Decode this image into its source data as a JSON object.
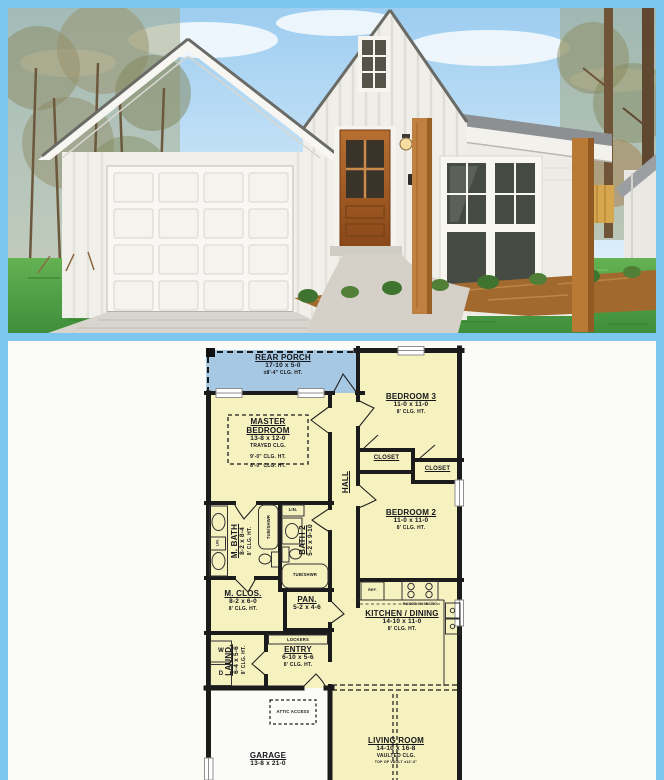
{
  "colors": {
    "frame_blue": "#7cc6ef",
    "plan_paper": "#fbfbf7",
    "room_yellow": "#f6f2c0",
    "porch_blue": "#a6c8e2",
    "wall_black": "#1b1b1b",
    "door_wood": "#a55f28",
    "grass_green": "#4f9e45",
    "sky_blue": "#9dcdf0"
  },
  "floor_plan": {
    "rear_porch": {
      "name": "REAR PORCH",
      "dims": "17-10 x 5-0",
      "clg": "±8'-4\" CLG. HT."
    },
    "bedroom3": {
      "name": "BEDROOM 3",
      "dims": "11-0 x 11-0",
      "clg": "8' CLG. HT."
    },
    "master_bedroom": {
      "name1": "MASTER",
      "name2": "BEDROOM",
      "dims": "13-8 x 12-0",
      "clg1": "TRAYED CLG.",
      "clg2": "9'-0\" CLG. HT.",
      "clg3": "8'-0\" CLG. HT."
    },
    "closet_left": {
      "name": "CLOSET"
    },
    "closet_right": {
      "name": "CLOSET"
    },
    "bedroom2": {
      "name": "BEDROOM 2",
      "dims": "11-0 x 11-0",
      "clg": "8' CLG. HT."
    },
    "hall": {
      "name": "HALL"
    },
    "master_bath": {
      "name": "M. BATH",
      "dims": "8-2 x 8-4",
      "clg": "8' CLG. HT."
    },
    "bath2": {
      "name": "BATH 2",
      "dims": "5-2 x 9-10"
    },
    "master_closet": {
      "name": "M. CLOS.",
      "dims": "8-2 x 6-0",
      "clg": "8' CLG. HT."
    },
    "pantry": {
      "name": "PAN.",
      "dims": "5-2 x 4-6"
    },
    "kitchen_dining": {
      "name": "KITCHEN / DINING",
      "dims": "14-10 x 11-0",
      "clg": "8' CLG. HT."
    },
    "laundry": {
      "name": "LAUND.",
      "dims": "6-4 x 5-6",
      "clg": "8' CLG. HT."
    },
    "entry": {
      "name": "ENTRY",
      "dims": "6-10 x 5-6",
      "clg": "8' CLG. HT."
    },
    "garage": {
      "name": "GARAGE",
      "dims": "13-8 x 21-0"
    },
    "living_room": {
      "name": "LIVING ROOM",
      "dims": "14-10 x 16-8",
      "clg1": "VAULTED CLG.",
      "clg2": "TOP OF VAULT ±12'-0\""
    },
    "fixtures": {
      "tub_shower_master": "TUB/SHWR",
      "tub_shower_bath2": "TUB/SHWR",
      "linen_master": "LIN.",
      "linen_bath2": "LIN.",
      "lockers": "LOCKERS",
      "attic_access": "ATTIC ACCESS",
      "range": "RANGE W/ MICRO",
      "refrigerator": "REF.",
      "washer": "W",
      "dryer": "D"
    }
  }
}
